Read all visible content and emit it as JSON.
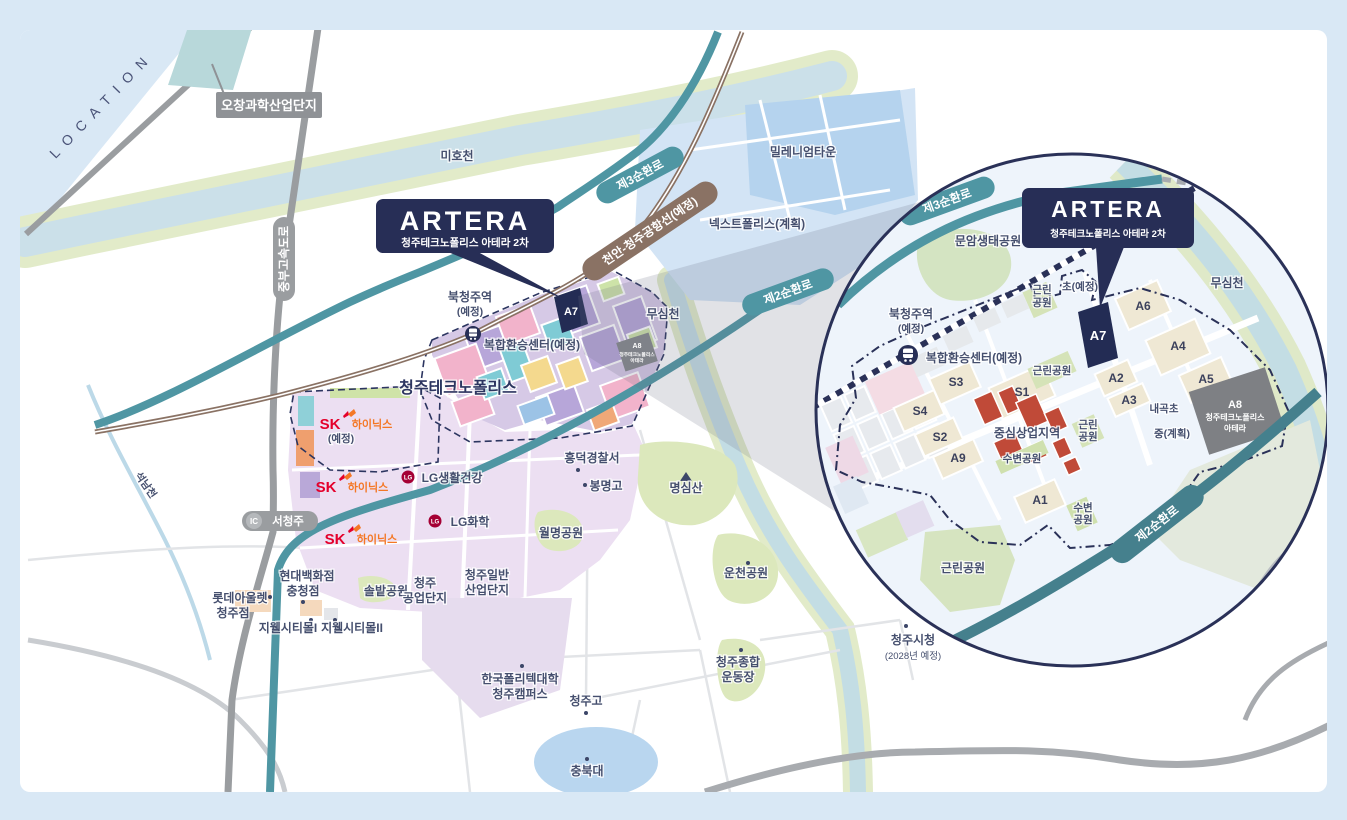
{
  "page": {
    "location": "LOCATION"
  },
  "logo": {
    "brand": "ARTERA",
    "subtitle": "청주테크노폴리스 아테라 2차"
  },
  "main": {
    "badges": {
      "ochang": "오창과학산업단지",
      "jungbu_expressway": "중부고속도로",
      "ring3": "제3순환로",
      "airport_line": "천안-청주공항선(예정)",
      "ring2": "제2순환로",
      "ic": "IC",
      "seocheongju": "서청주"
    },
    "rivers": {
      "mihocheon": "미호천",
      "musimcheon": "무심천",
      "seoknamcheon": "석남천"
    },
    "districts": {
      "millennium_town": "밀레니엄타운",
      "nextpolis": "넥스트폴리스(계획)",
      "technopolis": "청주테크노폴리스",
      "industrial1a": "청주",
      "industrial1b": "공업단지",
      "industrial2a": "청주일반",
      "industrial2b": "산업단지"
    },
    "station": {
      "name": "북청주역",
      "planned": "(예정)",
      "transfer_center": "복합환승센터(예정)"
    },
    "site": {
      "a7": "A7",
      "a8": "A8",
      "a8_sub1": "청주테크노폴리스",
      "a8_sub2": "아테라"
    },
    "companies": {
      "sk": "SK",
      "sk_hynix": "하이닉스",
      "sk_note": "(예정)",
      "lg": "LG",
      "lg_household": "LG생활건강",
      "lg_chem": "LG화학"
    },
    "pois": {
      "heungdeok_police": "흥덕경찰서",
      "bongmyeong_hs": "봉명고",
      "myeongsim_mt": "명심산",
      "wolmyeong_park": "월명공원",
      "uncheon_park": "운천공원",
      "hyundai_dept1": "현대백화점",
      "hyundai_dept2": "충청점",
      "lotte_outlet1": "롯데아울렛",
      "lotte_outlet2": "청주점",
      "solbat_park": "솔밭공원",
      "jiwell_mall1": "지웰시티몰I",
      "jiwell_mall2": "지웰시티몰II",
      "polytech1": "한국폴리텍대학",
      "polytech2": "청주캠퍼스",
      "cheongju_hs": "청주고",
      "chungbuk_univ": "충북대",
      "stadium1": "청주종합",
      "stadium2": "운동장",
      "city_hall": "청주시청",
      "city_hall_note": "(2028년 예정)"
    }
  },
  "inset": {
    "badges": {
      "ring3": "제3순환로",
      "ring2": "제2순환로"
    },
    "station": {
      "name": "북청주역",
      "planned": "(예정)",
      "transfer_center": "복합환승센터(예정)"
    },
    "parks": {
      "munam_eco": "문암생태공원",
      "green1": "근린",
      "green2": "공원",
      "green_park": "근린공원",
      "waterside_park": "수변공원",
      "waterside1": "수변",
      "waterside2": "공원"
    },
    "schools": {
      "elem_planned": "초(예정)",
      "naegok_elem": "내곡초",
      "middle_planned": "중(계획)"
    },
    "blocks": {
      "a1": "A1",
      "a2": "A2",
      "a3": "A3",
      "a4": "A4",
      "a5": "A5",
      "a6": "A6",
      "a7": "A7",
      "a9": "A9",
      "s1": "S1",
      "s2": "S2",
      "s3": "S3",
      "s4": "S4"
    },
    "a8": {
      "code": "A8",
      "sub1": "청주테크노폴리스",
      "sub2": "아테라"
    },
    "central_commercial": "중심상업지역",
    "river": "무심천"
  },
  "colors": {
    "navy": "#272e56",
    "teal_road": "#4f96a3",
    "rail_brown": "#8a7264",
    "page_bg": "#d9e8f5",
    "site_dark": "#232c54",
    "block_beige": "#efe8d4",
    "block_red": "#c04a38",
    "block_gray": "#7e8084",
    "sk_red": "#e4002b",
    "sk_orange": "#f47725",
    "lg_red": "#a50034"
  }
}
